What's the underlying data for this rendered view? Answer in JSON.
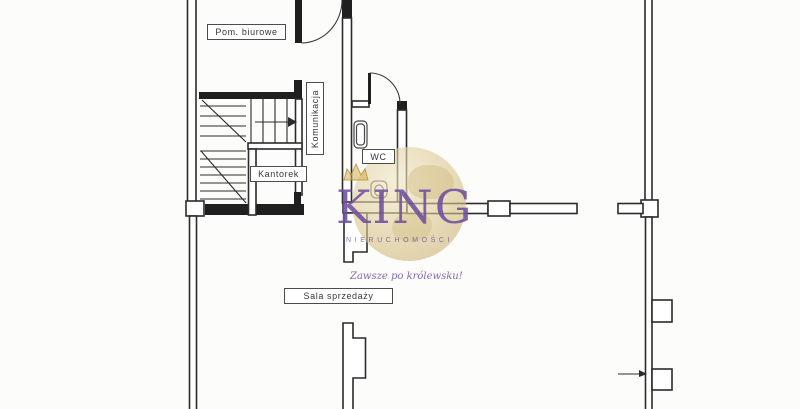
{
  "floorplan": {
    "background": "#fcfcfa",
    "wall_color": "#2b2b2b",
    "rooms": [
      {
        "id": "pom_biurowe",
        "label": "Pom. biurowe"
      },
      {
        "id": "komunikacja",
        "label": "Komunikacja"
      },
      {
        "id": "kantorek",
        "label": "Kantorek"
      },
      {
        "id": "wc",
        "label": "WC"
      },
      {
        "id": "sala_sprzedazy",
        "label": "Sala sprzedaży"
      }
    ],
    "fixtures": [
      "staircase",
      "washbasin",
      "toilet",
      "door-swing"
    ]
  },
  "watermark": {
    "brand": "KING",
    "tagline": "NIERUCHOMOŚCI",
    "slogan": "Zawsze po królewsku!",
    "brand_color": "#6e4f9e",
    "globe_color": "#d8c592",
    "crown_color": "#cfa94a"
  }
}
